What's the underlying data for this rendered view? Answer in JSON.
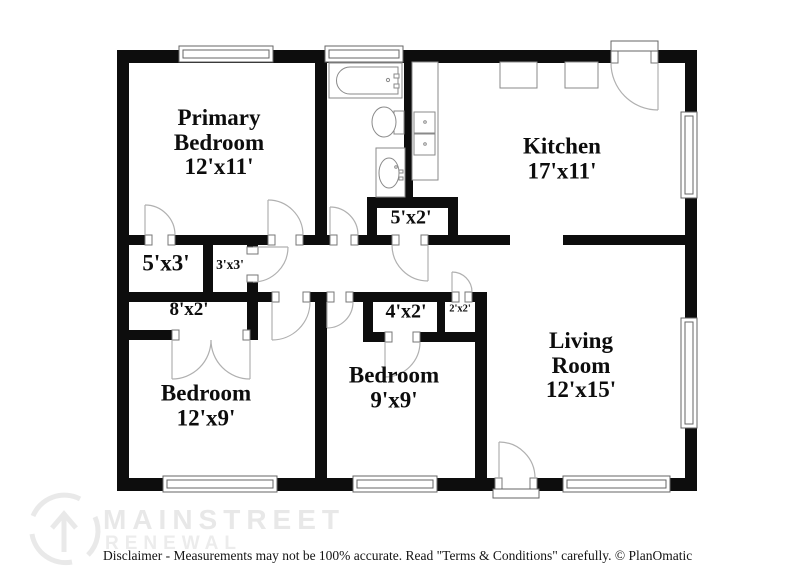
{
  "floorplan": {
    "rooms": [
      {
        "id": "primary-bedroom",
        "line1": "Primary",
        "line2": "Bedroom",
        "dims": "12'x11'"
      },
      {
        "id": "kitchen",
        "line1": "Kitchen",
        "dims": "17'x11'"
      },
      {
        "id": "living-room",
        "line1": "Living",
        "line2": "Room",
        "dims": "12'x15'"
      },
      {
        "id": "bedroom-12x9",
        "line1": "Bedroom",
        "dims": "12'x9'"
      },
      {
        "id": "bedroom-9x9",
        "line1": "Bedroom",
        "dims": "9'x9'"
      }
    ],
    "closets": [
      {
        "dims": "5'x3'"
      },
      {
        "dims": "3'x3'"
      },
      {
        "dims": "8'x2'"
      },
      {
        "dims": "5'x2'"
      },
      {
        "dims": "4'x2'"
      },
      {
        "dims": "2'x2'"
      }
    ],
    "fixtures": [
      "bathtub",
      "toilet",
      "vanity-sink",
      "kitchen-counter",
      "kitchen-double-sink",
      "appliances"
    ]
  },
  "watermark": {
    "brand_line1": "MAINSTREET",
    "brand_line2": "RENEWAL"
  },
  "footer": {
    "disclaimer": "Disclaimer - Measurements may not be 100% accurate. Read \"Terms & Conditions\" carefully. © PlanOmatic"
  },
  "colors": {
    "wall": "#0d0d0d",
    "door_arc": "#b0b0b0",
    "fixture_outline": "#8a8a8a",
    "watermark": "#e8e8e8",
    "text": "#0d0d0d"
  }
}
